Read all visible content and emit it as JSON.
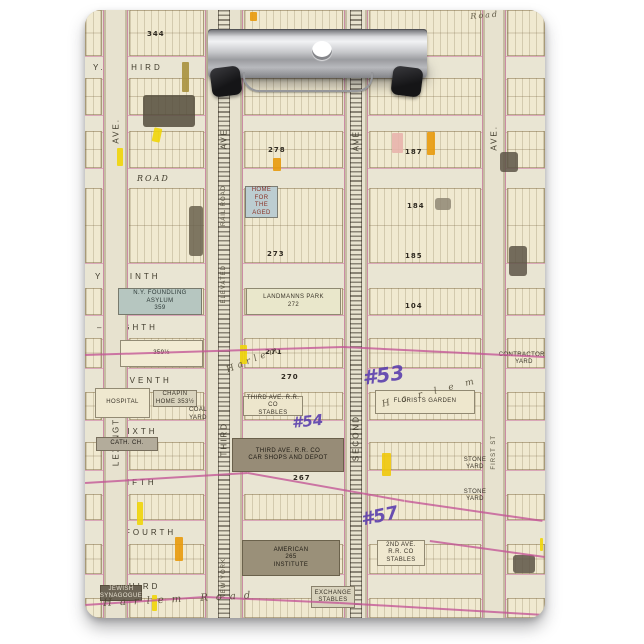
{
  "scene": {
    "background": "#ffffff",
    "board": {
      "x": 85,
      "y": 10,
      "w": 460,
      "h": 608,
      "radius": 16,
      "paper": "#e4e0cd"
    },
    "clip_parts": [
      "clip-body",
      "clip-top-bar",
      "hang-hole",
      "corner-grip-left",
      "corner-grip-right",
      "wire-lever"
    ]
  },
  "map": {
    "colors": {
      "paper": "#e4e0cd",
      "street": "#e9e5d3",
      "block": "#f0e9d0",
      "pink_line": "#c3558f",
      "purple_ink": "#5b3fae",
      "yellow": "#efd509",
      "orange": "#e89a0c",
      "blue_block": "#b6c6c0",
      "rail_dark": "#2d261c"
    },
    "rows": [
      {
        "y": 0,
        "h": 46
      },
      {
        "y": 68,
        "h": 37
      },
      {
        "y": 121,
        "h": 37
      },
      {
        "y": 178,
        "h": 75
      },
      {
        "y": 278,
        "h": 27
      },
      {
        "y": 328,
        "h": 30
      },
      {
        "y": 382,
        "h": 28
      },
      {
        "y": 432,
        "h": 28
      },
      {
        "y": 484,
        "h": 26
      },
      {
        "y": 534,
        "h": 30
      },
      {
        "y": 588,
        "h": 20
      }
    ],
    "cols": [
      {
        "x": 0,
        "w": 17
      },
      {
        "x": 44,
        "w": 75
      },
      {
        "x": 159,
        "w": 99
      },
      {
        "x": 284,
        "w": 112
      },
      {
        "x": 422,
        "w": 38
      }
    ],
    "streets": [
      {
        "id": "third-top",
        "label": "Y. – THIRD",
        "y": 46,
        "h": 22,
        "lx": 8
      },
      {
        "id": "unnamed",
        "label": "",
        "y": 105,
        "h": 16,
        "lx": 0
      },
      {
        "id": "road",
        "label": "ROAD",
        "y": 158,
        "h": 20,
        "lx": 52,
        "italic": true
      },
      {
        "id": "ninth",
        "label": "Y – NINTH",
        "y": 253,
        "h": 25,
        "lx": 10
      },
      {
        "id": "eighth",
        "label": "– EIGHTH",
        "y": 305,
        "h": 23,
        "lx": 12
      },
      {
        "id": "seventh",
        "label": "SEVENTH",
        "y": 358,
        "h": 24,
        "lx": 28
      },
      {
        "id": "sixth",
        "label": "SIXTH",
        "y": 410,
        "h": 22,
        "lx": 34
      },
      {
        "id": "fifth",
        "label": "FIFTH",
        "y": 460,
        "h": 24,
        "lx": 34
      },
      {
        "id": "fourth",
        "label": "FOURTH",
        "y": 510,
        "h": 24,
        "lx": 40
      },
      {
        "id": "third-bottom",
        "label": "THIRD",
        "y": 564,
        "h": 24,
        "lx": 36
      }
    ],
    "corridors": [
      {
        "name": "lexington-ave",
        "x": 18,
        "w": 25,
        "rail": false,
        "labels": [
          {
            "t": "AVE.",
            "y": 108
          },
          {
            "t": "LEXINGTON",
            "y": 392
          }
        ]
      },
      {
        "name": "third-ave-elevated",
        "x": 120,
        "w": 38,
        "rail": true,
        "labels": [
          {
            "t": "AVE",
            "y": 118
          },
          {
            "t": "RAIL ROAD",
            "y": 175,
            "small": true
          },
          {
            "t": "ELEVATED",
            "y": 255,
            "small": true
          },
          {
            "t": "THIRD",
            "y": 412
          },
          {
            "t": "NEW YORK",
            "y": 548,
            "small": true
          }
        ]
      },
      {
        "name": "second-ave",
        "x": 259,
        "w": 24,
        "rail": true,
        "labels": [
          {
            "t": "AVE",
            "y": 120
          },
          {
            "t": "SECOND",
            "y": 405
          }
        ]
      },
      {
        "name": "first-ave",
        "x": 397,
        "w": 24,
        "rail": false,
        "labels": [
          {
            "t": "AVE.",
            "y": 115
          },
          {
            "t": "FIRST ST",
            "y": 425,
            "small": true
          }
        ]
      }
    ],
    "landmarks": [
      {
        "name": "foundling-asylum",
        "x": 33,
        "y": 278,
        "w": 84,
        "h": 27,
        "bg": "#b6c6c0",
        "fg": "#2e3a38",
        "label": "N.Y. FOUNDLING ASYLUM\n359"
      },
      {
        "name": "home-for-aged",
        "x": 160,
        "y": 176,
        "w": 33,
        "h": 32,
        "bg": "#bccdd1",
        "fg": "#8a3326",
        "label": "HOME FOR\nTHE AGED"
      },
      {
        "name": "block-359-half",
        "x": 35,
        "y": 330,
        "w": 83,
        "h": 27,
        "bg": "#f2ebd3",
        "fg": "#2f2a1f",
        "label": "359½"
      },
      {
        "name": "landmanns-park",
        "x": 161,
        "y": 278,
        "w": 95,
        "h": 27,
        "bg": "#e9e7cb",
        "fg": "#3a3429",
        "label": "LANDMANNS PARK\n272"
      },
      {
        "name": "hospital",
        "x": 10,
        "y": 378,
        "w": 55,
        "h": 30,
        "bg": "#efe8cf",
        "fg": "#3a3429",
        "label": "HOSPITAL"
      },
      {
        "name": "chapin-home",
        "x": 68,
        "y": 380,
        "w": 44,
        "h": 17,
        "bg": "#d9d3bd",
        "fg": "#3a3429",
        "label": "CHAPIN\nHOME 353½"
      },
      {
        "name": "coal-yard",
        "x": 100,
        "y": 399,
        "w": 26,
        "h": 11,
        "bg": "transparent",
        "fg": "#3a3429",
        "label": "COAL\nYARD"
      },
      {
        "name": "catholic-church",
        "x": 11,
        "y": 427,
        "w": 62,
        "h": 14,
        "bg": "#b3ac9b",
        "fg": "#24201a",
        "hatch": true,
        "label": "CATH. CH."
      },
      {
        "name": "third-ave-rr-stables",
        "x": 158,
        "y": 386,
        "w": 60,
        "h": 20,
        "bg": "#ede6cc",
        "fg": "#3a3429",
        "xbrace": true,
        "label": "THIRD AVE. R.R. CO\nSTABLES"
      },
      {
        "name": "third-ave-car-shops",
        "x": 147,
        "y": 428,
        "w": 112,
        "h": 34,
        "bg": "#978c77",
        "fg": "#1f1b14",
        "hatch": true,
        "label": "THIRD AVE. R.R. CO\nCAR SHOPS AND DEPOT"
      },
      {
        "name": "american-institute",
        "x": 157,
        "y": 530,
        "w": 98,
        "h": 36,
        "bg": "#9a9079",
        "fg": "#1f1b14",
        "hatch": true,
        "label": "AMERICAN\n265\nINSTITUTE"
      },
      {
        "name": "florists-garden",
        "x": 290,
        "y": 380,
        "w": 100,
        "h": 24,
        "bg": "#eee7cd",
        "fg": "#3a3429",
        "label": "FLORISTS GARDEN"
      },
      {
        "name": "jewish-synagogue",
        "x": 15,
        "y": 575,
        "w": 42,
        "h": 16,
        "bg": "#6b6354",
        "fg": "#e8e2d2",
        "hatch": true,
        "label": "JEWISH\nSYNAGOGUE"
      },
      {
        "name": "contractors-yard",
        "x": 420,
        "y": 342,
        "w": 38,
        "h": 14,
        "bg": "transparent",
        "fg": "#3a3429",
        "label": "CONTRACTORS\nYARD"
      },
      {
        "name": "stone-yard-1",
        "x": 375,
        "y": 448,
        "w": 30,
        "h": 12,
        "bg": "transparent",
        "fg": "#3a3429",
        "label": "STONE\nYARD"
      },
      {
        "name": "stone-yard-2",
        "x": 375,
        "y": 480,
        "w": 30,
        "h": 12,
        "bg": "transparent",
        "fg": "#3a3429",
        "label": "STONE\nYARD"
      },
      {
        "name": "second-ave-rr-stables",
        "x": 292,
        "y": 530,
        "w": 48,
        "h": 26,
        "bg": "#efe8cf",
        "fg": "#3a3429",
        "label": "2ND AVE.\nR.R. CO\nSTABLES"
      },
      {
        "name": "exchange-stables",
        "x": 226,
        "y": 576,
        "w": 44,
        "h": 22,
        "bg": "#d9d3bd",
        "fg": "#3a3429",
        "label": "EXCHANGE\nSTABLES"
      }
    ],
    "block_numbers": [
      {
        "n": "344",
        "x": 62,
        "y": 20
      },
      {
        "n": "278",
        "x": 183,
        "y": 136
      },
      {
        "n": "187",
        "x": 320,
        "y": 138
      },
      {
        "n": "184",
        "x": 322,
        "y": 192
      },
      {
        "n": "273",
        "x": 182,
        "y": 240
      },
      {
        "n": "185",
        "x": 320,
        "y": 242
      },
      {
        "n": "104",
        "x": 320,
        "y": 292
      },
      {
        "n": "271",
        "x": 180,
        "y": 338
      },
      {
        "n": "270",
        "x": 196,
        "y": 363
      },
      {
        "n": "267",
        "x": 208,
        "y": 464
      }
    ],
    "highlights": [
      {
        "x": 165,
        "y": 2,
        "w": 7,
        "h": 9,
        "c": "#e89a0c"
      },
      {
        "x": 97,
        "y": 52,
        "w": 7,
        "h": 30,
        "c": "#a8913d"
      },
      {
        "x": 68,
        "y": 118,
        "w": 8,
        "h": 14,
        "c": "#efd509",
        "r": 12
      },
      {
        "x": 32,
        "y": 138,
        "w": 6,
        "h": 18,
        "c": "#efd509"
      },
      {
        "x": 188,
        "y": 148,
        "w": 8,
        "h": 13,
        "c": "#e89a0c"
      },
      {
        "x": 307,
        "y": 123,
        "w": 11,
        "h": 20,
        "c": "#e8b4ac"
      },
      {
        "x": 342,
        "y": 122,
        "w": 8,
        "h": 23,
        "c": "#e89a0c"
      },
      {
        "x": 155,
        "y": 335,
        "w": 7,
        "h": 19,
        "c": "#efd509"
      },
      {
        "x": 297,
        "y": 443,
        "w": 9,
        "h": 23,
        "c": "#f0c80a"
      },
      {
        "x": 52,
        "y": 492,
        "w": 6,
        "h": 23,
        "c": "#efd509"
      },
      {
        "x": 90,
        "y": 527,
        "w": 8,
        "h": 24,
        "c": "#e89a0c"
      },
      {
        "x": 67,
        "y": 585,
        "w": 5,
        "h": 16,
        "c": "#efd509"
      },
      {
        "x": 455,
        "y": 528,
        "w": 3,
        "h": 13,
        "c": "#efd509"
      }
    ],
    "dark_buildings": [
      {
        "x": 58,
        "y": 85,
        "w": 52,
        "h": 32,
        "c": "#544c3c"
      },
      {
        "x": 104,
        "y": 196,
        "w": 14,
        "h": 50,
        "c": "#6a614e"
      },
      {
        "x": 415,
        "y": 142,
        "w": 18,
        "h": 20,
        "c": "#5d5546"
      },
      {
        "x": 424,
        "y": 236,
        "w": 18,
        "h": 30,
        "c": "#5d5546"
      },
      {
        "x": 428,
        "y": 545,
        "w": 22,
        "h": 18,
        "c": "#5d5546"
      },
      {
        "x": 350,
        "y": 188,
        "w": 16,
        "h": 12,
        "c": "#8f8774"
      }
    ],
    "pink_lines": [
      {
        "x1": 0,
        "y1": 344,
        "x2": 258,
        "y2": 336
      },
      {
        "x1": 258,
        "y1": 336,
        "x2": 460,
        "y2": 346
      },
      {
        "x1": 0,
        "y1": 472,
        "x2": 163,
        "y2": 462
      },
      {
        "x1": 163,
        "y1": 462,
        "x2": 320,
        "y2": 490
      },
      {
        "x1": 320,
        "y1": 490,
        "x2": 458,
        "y2": 510
      },
      {
        "x1": 345,
        "y1": 530,
        "x2": 460,
        "y2": 546
      },
      {
        "x1": 0,
        "y1": 594,
        "x2": 120,
        "y2": 586
      },
      {
        "x1": 120,
        "y1": 586,
        "x2": 255,
        "y2": 592
      },
      {
        "x1": 255,
        "y1": 592,
        "x2": 460,
        "y2": 604
      }
    ],
    "purple_annotations": [
      {
        "t": "#53",
        "x": 276,
        "y": 356,
        "r": -8,
        "s": 20
      },
      {
        "t": "#54",
        "x": 206,
        "y": 404,
        "r": -6,
        "s": 15
      },
      {
        "t": "#57",
        "x": 274,
        "y": 500,
        "r": -12,
        "s": 18
      }
    ],
    "script_labels": [
      {
        "t": "Harlem",
        "x": 140,
        "y": 356,
        "r": -22,
        "ls": 4,
        "s": 9
      },
      {
        "t": "Harlem",
        "x": 296,
        "y": 390,
        "r": -14,
        "ls": 12,
        "s": 9
      },
      {
        "t": "Harlem Road",
        "x": 18,
        "y": 588,
        "r": -3,
        "ls": 8,
        "s": 10
      },
      {
        "t": "Road",
        "x": 385,
        "y": 2,
        "r": -5,
        "ls": 2,
        "s": 8
      }
    ]
  }
}
